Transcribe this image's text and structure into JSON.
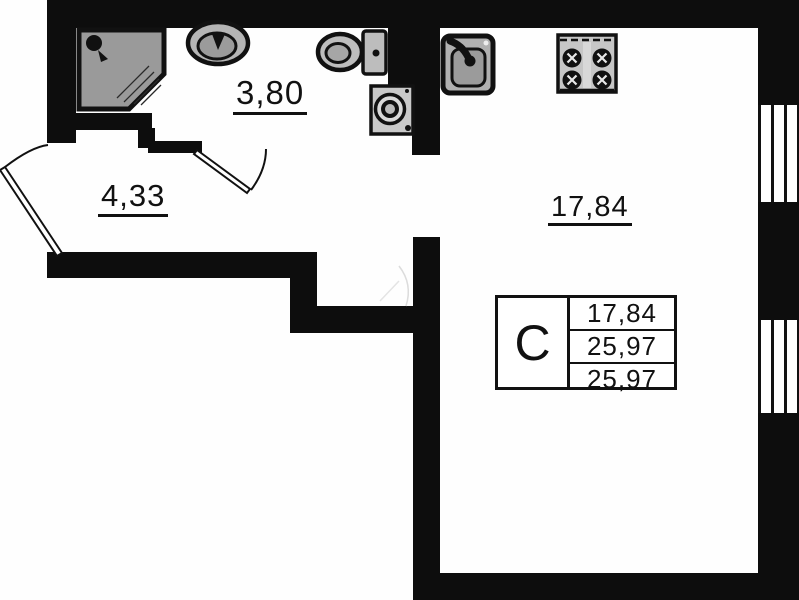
{
  "plan": {
    "type": "apartment-floor-plan",
    "rooms": {
      "bathroom": {
        "area": "3,80"
      },
      "hallway": {
        "area": "4,33"
      },
      "living_room": {
        "area": "17,84"
      }
    },
    "stamp": {
      "type_label": "С",
      "rows": [
        "17,84",
        "25,97",
        "25,97"
      ]
    },
    "fixtures": [
      "shower-icon",
      "washbasin-icon",
      "toilet-icon",
      "washing-machine-icon",
      "kitchen-sink-icon",
      "stove-icon",
      "entrance-door-icon",
      "interior-door-icon"
    ],
    "colors": {
      "wall": "#0d0d0d",
      "fixture_gray": "#b5b5b5",
      "background": "#ffffff"
    },
    "windows_count": 2
  }
}
